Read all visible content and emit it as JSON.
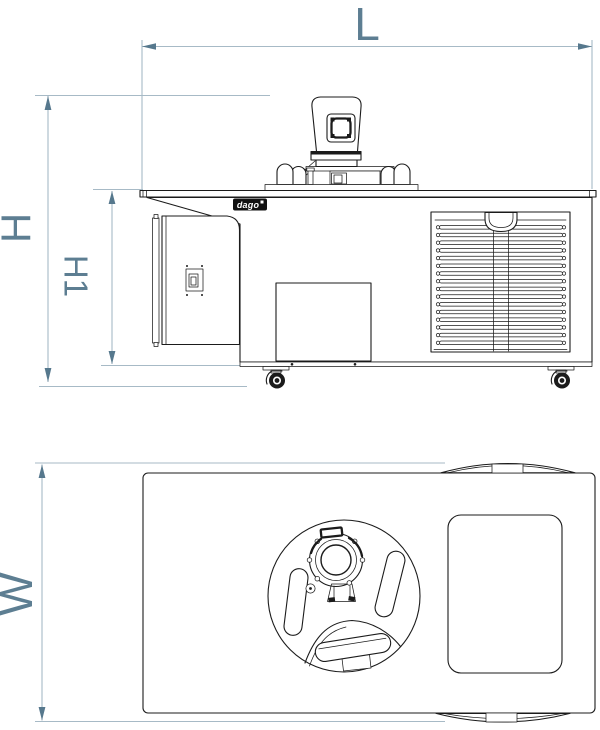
{
  "drawing": {
    "dimension_labels": {
      "length": "L",
      "height_total": "H",
      "height_body": "H1",
      "width": "W"
    },
    "logo": {
      "text": "dago"
    },
    "colors": {
      "dimension_lines": "#a7bac6",
      "dimension_arrows": "#56788d",
      "dimension_labels": "#5d7e92",
      "drawing_ink": "#1b1b1b",
      "background": "#ffffff"
    }
  }
}
